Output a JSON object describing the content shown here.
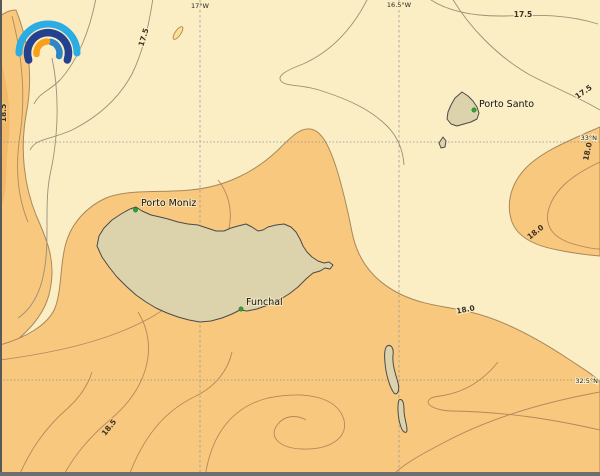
{
  "map": {
    "kind": "sea-temperature-contour-map",
    "grid": {
      "meridians": [
        {
          "label": "17°W"
        },
        {
          "label": "16.5°W"
        }
      ],
      "parallels": [
        {
          "label": "33°N"
        },
        {
          "label": "32.5°N"
        }
      ]
    },
    "contour_labels": [
      {
        "value": "17.5"
      },
      {
        "value": "17.5"
      },
      {
        "value": "17.5"
      },
      {
        "value": "18.0"
      },
      {
        "value": "18.0"
      },
      {
        "value": "18.0"
      },
      {
        "value": "18.5"
      },
      {
        "value": "18.5"
      }
    ],
    "places": [
      {
        "name": "Porto Moniz"
      },
      {
        "name": "Funchal"
      },
      {
        "name": "Porto Santo"
      }
    ],
    "colors": {
      "sea_cool": "#FBEEC5",
      "sea_warm": "#F8C87E",
      "sea_warmer": "#F3B96A",
      "land": "#DCD3AC",
      "contour_line": "#A8885A",
      "marker_green": "#2DA82D",
      "logo_outer_blue": "#2BACE2",
      "logo_navy": "#24418E",
      "logo_inner_blue": "#2E86C8",
      "logo_orange": "#F9A01B"
    }
  }
}
